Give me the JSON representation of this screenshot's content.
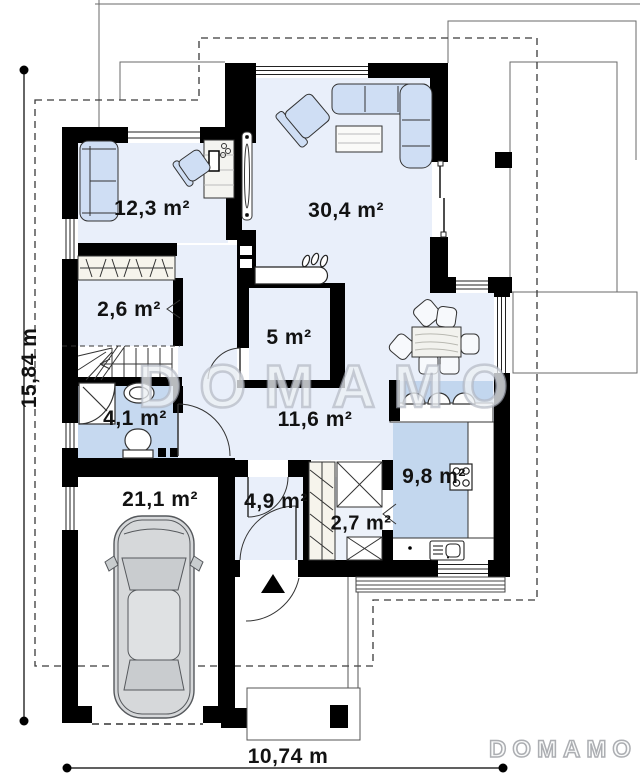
{
  "watermark": {
    "center": "DOMAMO",
    "corner": "DOMAMO"
  },
  "dimensions": {
    "height": "15,84 m",
    "width": "10,74 m"
  },
  "rooms": [
    {
      "id": "office",
      "area": "12,3 m²"
    },
    {
      "id": "living-room",
      "area": "30,4 m²"
    },
    {
      "id": "wardrobe",
      "area": "2,6 m²"
    },
    {
      "id": "storage",
      "area": "5 m²"
    },
    {
      "id": "bathroom",
      "area": "4,1 m²"
    },
    {
      "id": "hall",
      "area": "11,6 m²"
    },
    {
      "id": "garage",
      "area": "21,1 m²"
    },
    {
      "id": "entry",
      "area": "4,9 m²"
    },
    {
      "id": "pantry",
      "area": "2,7 m²"
    },
    {
      "id": "kitchen",
      "area": "9,8 m²"
    }
  ],
  "colors": {
    "floor": "#e9effa",
    "wet_floor": "#c6d9f0",
    "furniture": "#cfdef4",
    "wall": "#000000",
    "watermark_outline": "#b7bdc7"
  }
}
